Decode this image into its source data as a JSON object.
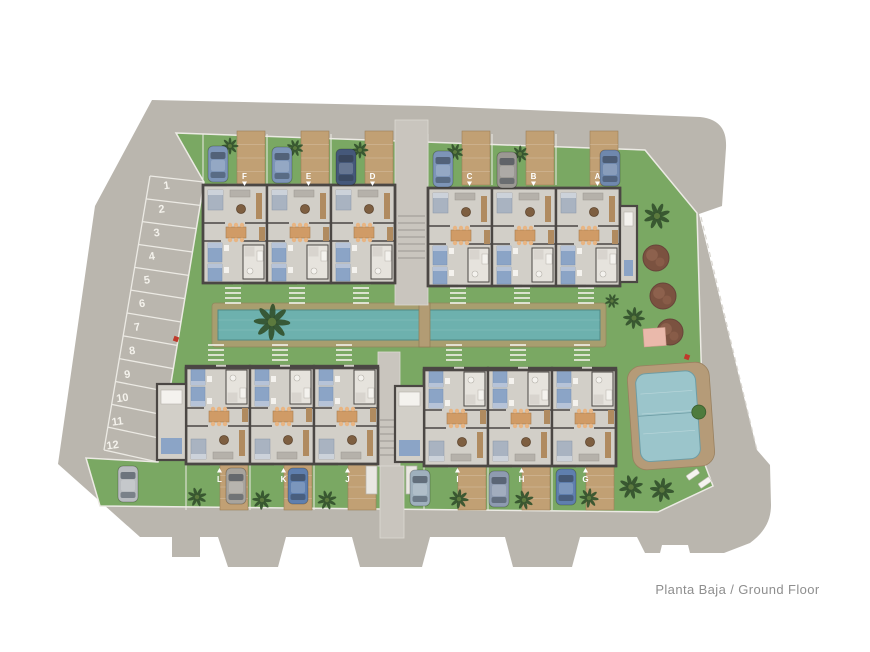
{
  "caption": "Planta Baja / Ground Floor",
  "palette": {
    "road": "#bab6ae",
    "walkway": "#c9c5be",
    "grass": "#7aa863",
    "wood_drive": "#c1a074",
    "pool_deck": "#a89e6f",
    "pool_water": "#6db1ae",
    "pool_water_edge": "#4f8a87",
    "communal_deck": "#b59b78",
    "communal_water": "#9bc5cb",
    "communal_water_edge": "#6e9da5",
    "wall": "#4b4744",
    "floor": "#d2cfc8",
    "white_line": "#eceae4",
    "bed_blue": "#8ba4c6",
    "bed_blue_pillow": "#b6c3d8",
    "bed_gray": "#a9b3c1",
    "sofa_gray": "#b5b1aa",
    "dining_wood": "#d09b66",
    "chair": "#e8b583",
    "wood_furniture": "#b08b60",
    "bath_floor": "#e6e3dd",
    "fixture_white": "#f4f2ee",
    "palm_dark": "#33512c",
    "palm_light": "#5c7a3e",
    "tree_brown": "#7b5240",
    "tree_brown_hi": "#a0705a",
    "pink_area": "#eab9ab",
    "red_accent": "#bf3a2b",
    "label_text": "#ffffff",
    "caption_text": "#8e8e8e",
    "stair": "#a5a19a"
  },
  "site": {
    "road_path": "M152,100 L430,106 L700,117 C718,119 727,128 726,148 L722,206 L699,214 L757,450 L770,465 L771,505 C771,523 762,534 750,543 L724,553 L690,553 L688,545 L662,545 L660,553 L645,553 L637,537 L580,537 L572,567 L513,567 L505,537 L430,537 L422,567 L360,567 L352,537 L286,537 L278,567 L228,567 L218,537 L200,537 L200,557 L172,557 L172,537 L140,537 L58,464 L95,206 Z",
    "green_path": "M176,133 L645,150 L697,213 L704,462 L713,486 L658,512 L100,506 L86,458 L158,462 L204,182 Z",
    "parcel_dash_line": [
      701,
      217,
      757,
      450
    ]
  },
  "parking": {
    "numbers": [
      "1",
      "2",
      "3",
      "4",
      "5",
      "6",
      "7",
      "8",
      "9",
      "10",
      "11",
      "12"
    ],
    "number_start": [
      167,
      189
    ],
    "number_step": [
      -4.9,
      23.6
    ],
    "left_edge": [
      150,
      176,
      104,
      450
    ],
    "right_edge": [
      204,
      182,
      158,
      462
    ]
  },
  "blocks": [
    {
      "id": "block-fed",
      "x": 203,
      "y": 185,
      "h": 98,
      "row": "top",
      "units": [
        "F",
        "E",
        "D"
      ]
    },
    {
      "id": "block-cba",
      "x": 428,
      "y": 188,
      "h": 98,
      "row": "top",
      "units": [
        "C",
        "B",
        "A"
      ],
      "wing": {
        "x": 620,
        "y": 206,
        "w": 17,
        "h": 76
      }
    },
    {
      "id": "block-lkj",
      "x": 186,
      "y": 368,
      "h": 96,
      "row": "bottom",
      "units": [
        "L",
        "K",
        "J"
      ],
      "wing": {
        "x": 157,
        "y": 384,
        "w": 29,
        "h": 76
      }
    },
    {
      "id": "block-ihg",
      "x": 424,
      "y": 370,
      "h": 96,
      "row": "bottom",
      "units": [
        "I",
        "H",
        "G"
      ],
      "wing": {
        "x": 395,
        "y": 386,
        "w": 29,
        "h": 76
      }
    }
  ],
  "unit_w": 64,
  "arrows": {
    "top": "down",
    "bottom": "up"
  },
  "pools": {
    "lap_pool": {
      "deck": [
        212,
        303,
        394,
        44
      ],
      "water": [
        218,
        310,
        382,
        30
      ],
      "bridge": [
        419,
        303,
        11,
        44
      ],
      "lane_x": 424
    },
    "communal_pool": {
      "deck": [
        630,
        364,
        82,
        104
      ],
      "water": [
        638,
        372,
        60,
        88
      ],
      "rotate": -4,
      "plant": [
        699,
        414
      ]
    }
  },
  "walkways": {
    "top": {
      "rect": [
        395,
        120,
        33,
        185
      ],
      "stairs_y": [
        216,
        262
      ]
    },
    "bottom": {
      "rect": [
        378,
        352,
        22,
        114
      ],
      "neck": [
        380,
        466,
        24,
        72
      ],
      "stairs_y": [
        420,
        456
      ],
      "pads": [
        [
          366,
          466,
          11,
          28
        ],
        [
          406,
          466,
          11,
          28
        ]
      ]
    }
  },
  "cars": {
    "top": [
      {
        "x": 208,
        "y": 146,
        "color": "#7d95b8"
      },
      {
        "x": 272,
        "y": 147,
        "color": "#7d95b8"
      },
      {
        "x": 336,
        "y": 149,
        "color": "#45587a"
      },
      {
        "x": 433,
        "y": 151,
        "color": "#7d95b8"
      },
      {
        "x": 497,
        "y": 152,
        "color": "#9b9893"
      },
      {
        "x": 600,
        "y": 150,
        "color": "#6f88ad"
      }
    ],
    "bottom": [
      {
        "x": 118,
        "y": 466,
        "color": "#b9bcc0"
      },
      {
        "x": 226,
        "y": 468,
        "color": "#a8a49d"
      },
      {
        "x": 288,
        "y": 468,
        "color": "#5f7fae"
      },
      {
        "x": 410,
        "y": 470,
        "color": "#9fb0bd"
      },
      {
        "x": 489,
        "y": 471,
        "color": "#8e9bb0"
      },
      {
        "x": 556,
        "y": 469,
        "color": "#5f7fae"
      }
    ]
  },
  "palms": [
    [
      230,
      146,
      7
    ],
    [
      295,
      148,
      7
    ],
    [
      360,
      150,
      7
    ],
    [
      455,
      152,
      7
    ],
    [
      520,
      154,
      7
    ],
    [
      657,
      216,
      11
    ],
    [
      272,
      322,
      15
    ],
    [
      612,
      301,
      6
    ],
    [
      634,
      318,
      9
    ],
    [
      197,
      497,
      8
    ],
    [
      262,
      500,
      8
    ],
    [
      327,
      500,
      8
    ],
    [
      459,
      499,
      8
    ],
    [
      524,
      500,
      8
    ],
    [
      589,
      498,
      8
    ],
    [
      631,
      487,
      10
    ],
    [
      662,
      490,
      10
    ]
  ],
  "round_trees": {
    "positions": [
      [
        656,
        258
      ],
      [
        663,
        296
      ],
      [
        670,
        332
      ]
    ],
    "radius": 13
  },
  "extras": {
    "pink_area": [
      643,
      329,
      22,
      18,
      -4
    ],
    "red_marks": [
      [
        176,
        339
      ],
      [
        687,
        357
      ]
    ],
    "loungers": [
      [
        686,
        476
      ],
      [
        698,
        484
      ]
    ]
  }
}
